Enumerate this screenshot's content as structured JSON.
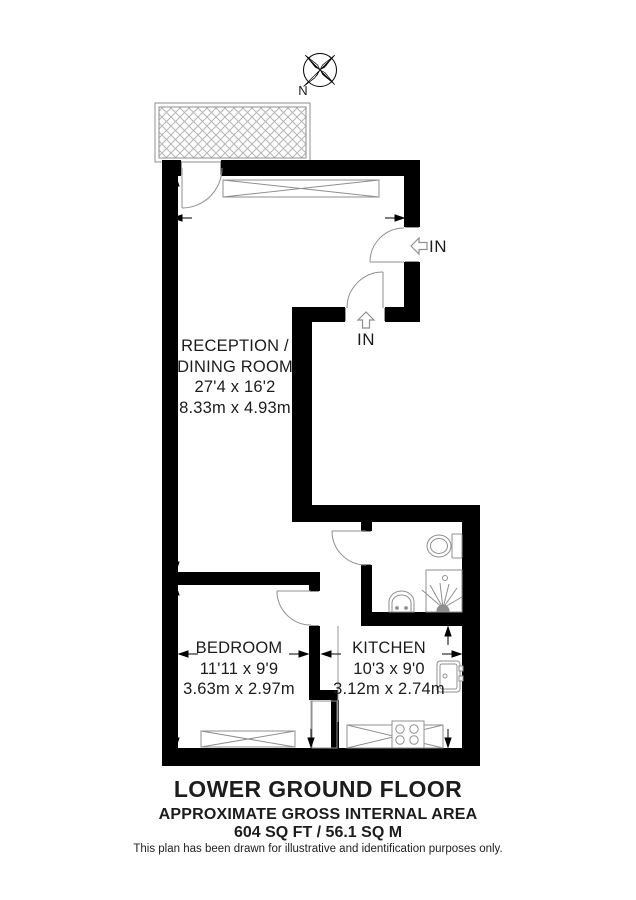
{
  "compass": {
    "label": "N"
  },
  "rooms": {
    "reception": {
      "line1": "RECEPTION /",
      "line2": "DINING ROOM",
      "dims_imperial": "27'4 x 16'2",
      "dims_metric": "8.33m x 4.93m"
    },
    "bedroom": {
      "name": "BEDROOM",
      "dims_imperial": "11'11 x 9'9",
      "dims_metric": "3.63m x 2.97m"
    },
    "kitchen": {
      "name": "KITCHEN",
      "dims_imperial": "10'3 x 9'0",
      "dims_metric": "3.12m x 2.74m"
    }
  },
  "entrances": {
    "side": {
      "label": "IN"
    },
    "rear": {
      "label": "IN"
    }
  },
  "footer": {
    "floor_title": "LOWER GROUND FLOOR",
    "area_heading": "APPROXIMATE GROSS INTERNAL AREA",
    "area_value": "604 SQ FT / 56.1 SQ M",
    "disclaimer": "This plan has been drawn for illustrative and identification purposes only."
  },
  "colors": {
    "wall": "#000000",
    "thin_line": "#8f8f8f",
    "hatch": "#b5b5b5",
    "background": "#ffffff"
  }
}
